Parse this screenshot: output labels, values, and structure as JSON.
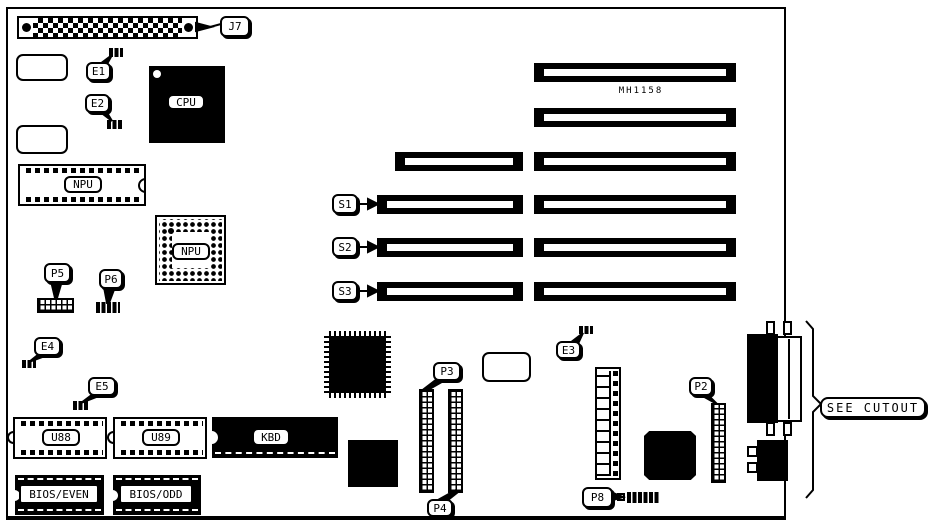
{
  "board": {
    "model_text": "MH1158",
    "cutout_note": "SEE CUTOUT"
  },
  "callouts": {
    "j7": "J7",
    "e1": "E1",
    "e2": "E2",
    "e3": "E3",
    "e4": "E4",
    "e5": "E5",
    "p2": "P2",
    "p3": "P3",
    "p4": "P4",
    "p5": "P5",
    "p6": "P6",
    "p8": "P8",
    "s1": "S1",
    "s2": "S2",
    "s3": "S3"
  },
  "chips": {
    "cpu": "CPU",
    "npu_socket": "NPU",
    "npu_pga": "NPU",
    "kbd": "KBD",
    "u88": "U88",
    "u89": "U89",
    "bios_even": "BIOS/EVEN",
    "bios_odd": "BIOS/ODD"
  },
  "colors": {
    "ink": "#000000",
    "paper": "#ffffff"
  }
}
